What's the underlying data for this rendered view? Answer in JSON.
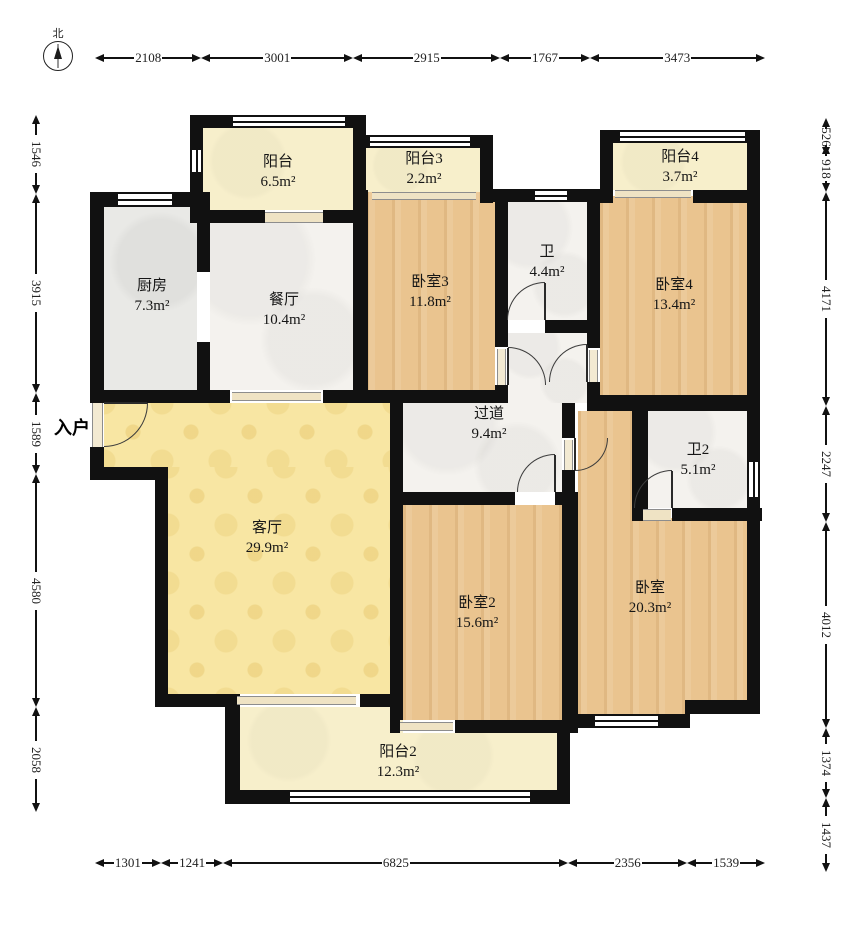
{
  "compass": {
    "label": "北"
  },
  "entry": {
    "label": "入户"
  },
  "rooms": [
    {
      "id": "balcony1",
      "name": "阳台",
      "area": "6.5m²"
    },
    {
      "id": "balcony3",
      "name": "阳台3",
      "area": "2.2m²"
    },
    {
      "id": "balcony4",
      "name": "阳台4",
      "area": "3.7m²"
    },
    {
      "id": "kitchen",
      "name": "厨房",
      "area": "7.3m²"
    },
    {
      "id": "dining",
      "name": "餐厅",
      "area": "10.4m²"
    },
    {
      "id": "bedroom3",
      "name": "卧室3",
      "area": "11.8m²"
    },
    {
      "id": "bath",
      "name": "卫",
      "area": "4.4m²"
    },
    {
      "id": "bedroom4",
      "name": "卧室4",
      "area": "13.4m²"
    },
    {
      "id": "hallway",
      "name": "过道",
      "area": "9.4m²"
    },
    {
      "id": "bath2",
      "name": "卫2",
      "area": "5.1m²"
    },
    {
      "id": "living",
      "name": "客厅",
      "area": "29.9m²"
    },
    {
      "id": "bedroom2",
      "name": "卧室2",
      "area": "15.6m²"
    },
    {
      "id": "bedroom",
      "name": "卧室",
      "area": "20.3m²"
    },
    {
      "id": "balcony2",
      "name": "阳台2",
      "area": "12.3m²"
    }
  ],
  "dimensions": {
    "top": [
      "2108",
      "3001",
      "2915",
      "1767",
      "3473"
    ],
    "bottom": [
      "1301",
      "1241",
      "6825",
      "2356",
      "1539"
    ],
    "left": [
      "1546",
      "3915",
      "1589",
      "4580",
      "2058"
    ],
    "right": [
      "526",
      "918",
      "4171",
      "2247",
      "4012",
      "1374",
      "1437"
    ]
  }
}
